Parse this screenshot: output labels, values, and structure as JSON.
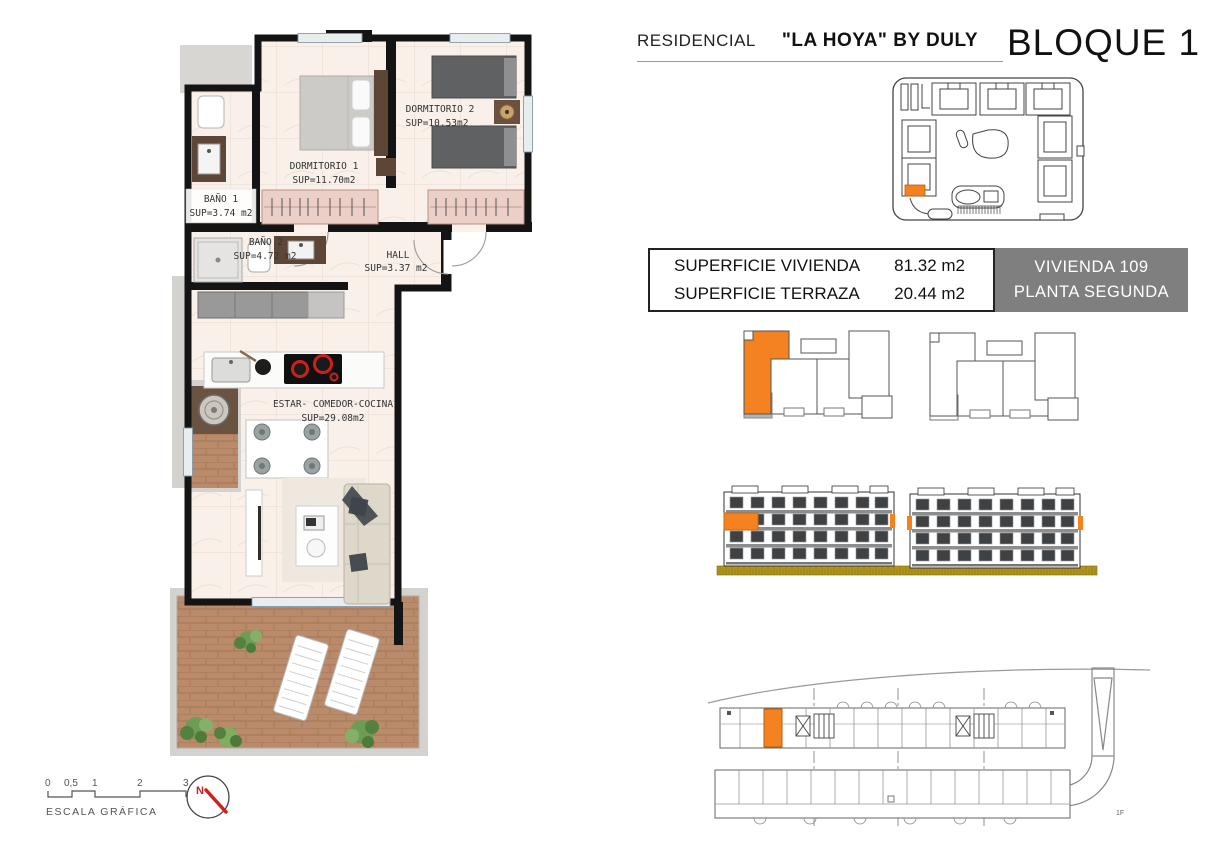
{
  "colors": {
    "accent_orange": "#F58220",
    "table_gray": "#7F7F7F",
    "ground_olive": "#B1951C",
    "wood": "#B98B6B",
    "floor_cream": "#F8F0E9"
  },
  "header": {
    "residencial_label": "RESIDENCIAL",
    "project_name": "\"LA HOYA\" BY DULY",
    "block_title": "BLOQUE 1"
  },
  "floor_plan": {
    "rooms": [
      {
        "name": "DORMITORIO 1",
        "sup": "SUP=11.70m2"
      },
      {
        "name": "DORMITORIO 2",
        "sup": "SUP=10.53m2"
      },
      {
        "name": "BAÑO 1",
        "sup": "SUP=3.74 m2"
      },
      {
        "name": "BAÑO 2",
        "sup": "SUP=4.72 m2"
      },
      {
        "name": "HALL",
        "sup": "SUP=3.37 m2"
      },
      {
        "name": "ESTAR- COMEDOR-COCINA",
        "sup": "SUP=29.08m2"
      }
    ]
  },
  "summary": {
    "rows": [
      {
        "label": "SUPERFICIE VIVIENDA",
        "value": "81.32 m2"
      },
      {
        "label": "SUPERFICIE TERRAZA",
        "value": "20.44 m2"
      }
    ],
    "unit_line1": "VIVIENDA 109",
    "unit_line2": "PLANTA SEGUNDA"
  },
  "scale_bar": {
    "label": "ESCALA GRÁFICA",
    "ticks": [
      "0",
      "0,5",
      "1",
      "2",
      "3"
    ]
  },
  "north_label": "N",
  "floor_tag": "1F"
}
